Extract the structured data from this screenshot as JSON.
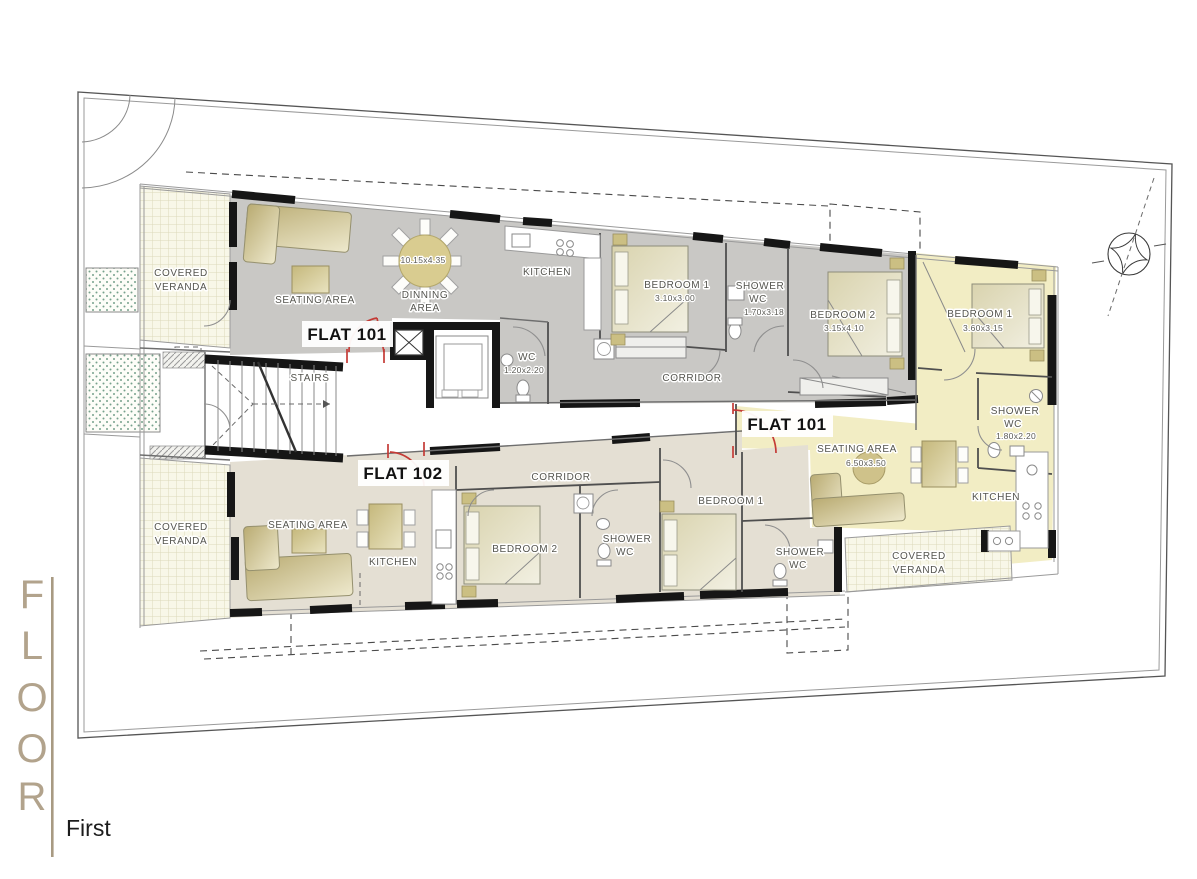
{
  "floor_tab": {
    "letters": [
      "F",
      "L",
      "O",
      "O",
      "R"
    ],
    "floor_name": "First"
  },
  "labels": {
    "veranda_tl": {
      "l1": "COVERED",
      "l2": "VERANDA"
    },
    "veranda_bl": {
      "l1": "COVERED",
      "l2": "VERANDA"
    },
    "veranda_br": {
      "l1": "COVERED",
      "l2": "VERANDA"
    },
    "common": {
      "stairs": "STAIRS",
      "wc": "WC",
      "wc_dims": "1.20x2.20"
    },
    "f101u": {
      "flat": "FLAT 101",
      "seating": "SEATING AREA",
      "dinning1": "DINNING",
      "dinning2": "AREA",
      "dinning_dims": "10.15x4.35",
      "kitchen": "KITCHEN",
      "bedroom1": "BEDROOM 1",
      "bedroom1_dims": "3.10x3.00",
      "shower1": "SHOWER",
      "shower2": "WC",
      "shower_dims": "1.70x3.18",
      "bedroom2": "BEDROOM 2",
      "bedroom2_dims": "3.15x4.10",
      "corridor": "CORRIDOR"
    },
    "f101r": {
      "flat": "FLAT 101",
      "bedroom1": "BEDROOM 1",
      "bedroom1_dims": "3.60x3.15",
      "shower1": "SHOWER",
      "shower2": "WC",
      "shower_dims": "1.80x2.20",
      "seating": "SEATING AREA",
      "seating_dims": "6.50x3.50",
      "kitchen": "KITCHEN"
    },
    "f102": {
      "flat": "FLAT 102",
      "seating": "SEATING AREA",
      "kitchen": "KITCHEN",
      "corridor": "CORRIDOR",
      "bedroom2": "BEDROOM 2",
      "shower_mid1": "SHOWER",
      "shower_mid2": "WC",
      "bedroom1": "BEDROOM 1",
      "shower_br1": "SHOWER",
      "shower_br2": "WC"
    }
  },
  "colors": {
    "flat101_upper_fill": "#c9c8c5",
    "flat101_right_fill": "#f2edc4",
    "flat102_fill": "#e4dfd3",
    "veranda_fill": "#f8f7e8",
    "furniture_tan": "#cfc28c",
    "door_red": "#c43b36",
    "wall_black": "#161616",
    "title_tan": "#b2a38c"
  }
}
